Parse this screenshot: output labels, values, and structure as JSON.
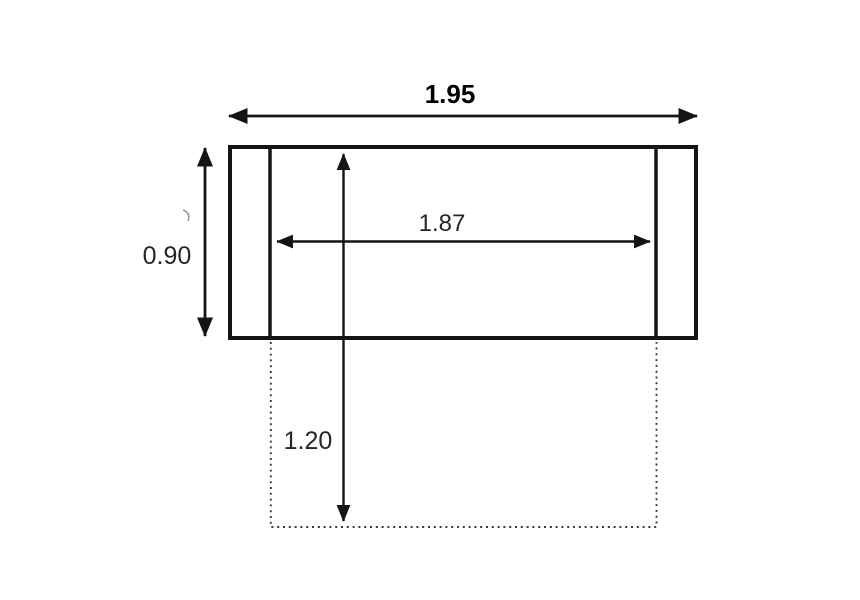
{
  "diagram": {
    "type": "dimensioned-technical-drawing",
    "background_color": "#ffffff",
    "line_color": "#141414",
    "dotted_line_color": "#3a3a3a",
    "text_color": "#262626",
    "bold_text_color": "#000000",
    "shapes": {
      "main_rectangle": "solid bold outline with two inner vertical divider lines",
      "extension_rectangle": "dotted outline extending below main rectangle between the inner dividers"
    },
    "dimensions": {
      "overall_width": {
        "label": "1.95",
        "orientation": "horizontal",
        "position": "above main rectangle",
        "style": "bold"
      },
      "overall_height": {
        "label": "0.90",
        "orientation": "vertical",
        "position": "left of main rectangle",
        "style": "regular"
      },
      "inner_width": {
        "label": "1.87",
        "orientation": "horizontal",
        "position": "inside main rectangle between dividers",
        "style": "regular"
      },
      "depth": {
        "label": "1.20",
        "orientation": "vertical",
        "position": "from rectangle top to bottom of dotted extension",
        "style": "regular"
      }
    }
  }
}
